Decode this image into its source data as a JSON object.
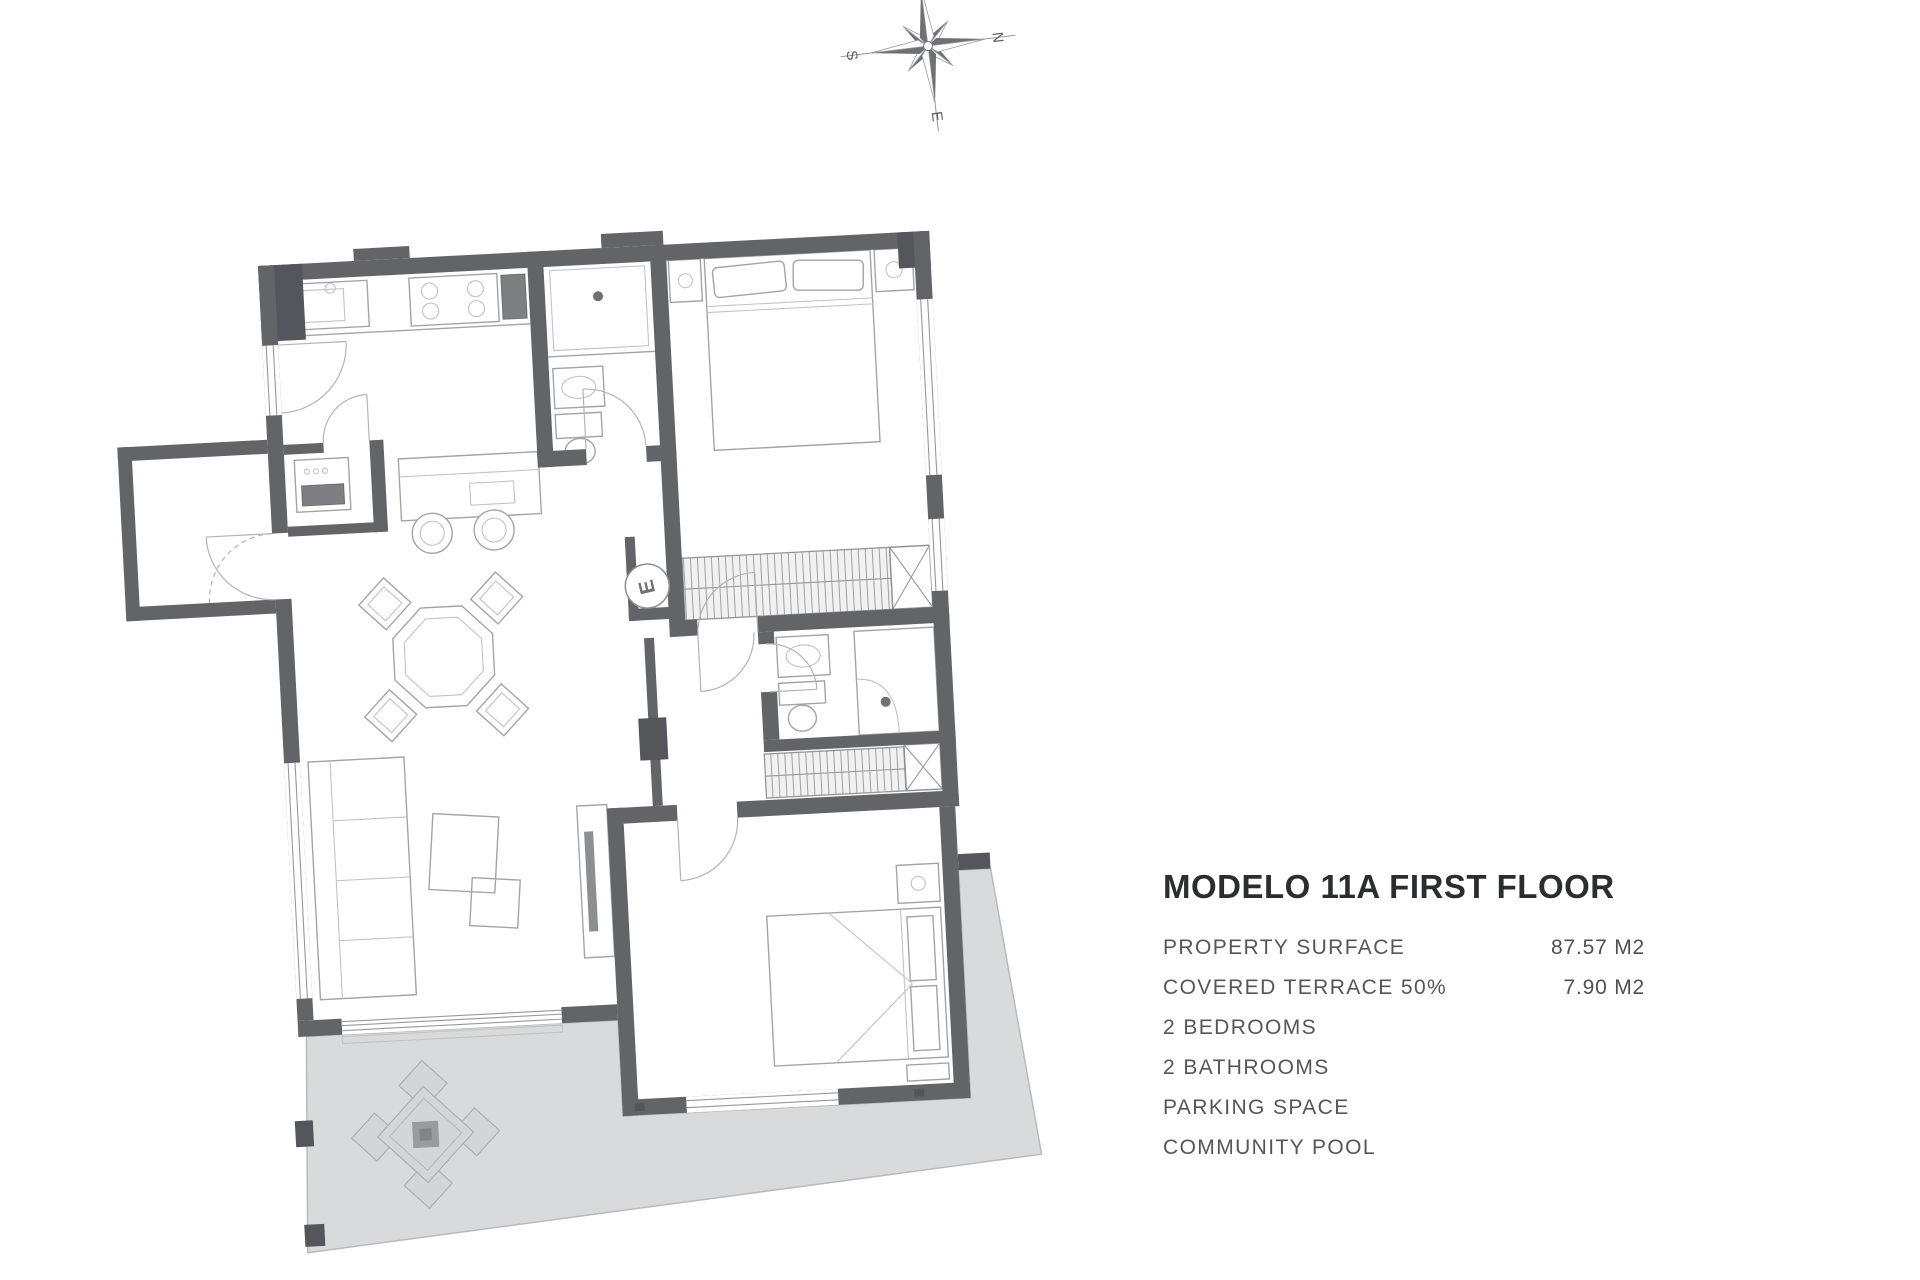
{
  "title": "MODELO 11A FIRST FLOOR",
  "specs": {
    "rows": [
      {
        "label": "PROPERTY SURFACE",
        "value": "87.57 M2"
      },
      {
        "label": "COVERED TERRACE 50%",
        "value": "7.90 M2"
      },
      {
        "label": "2 BEDROOMS",
        "value": ""
      },
      {
        "label": "2 BATHROOMS",
        "value": ""
      },
      {
        "label": "PARKING SPACE",
        "value": ""
      },
      {
        "label": "COMMUNITY POOL",
        "value": ""
      }
    ]
  },
  "compass": {
    "labels": {
      "north": "N",
      "east": "E",
      "south": "S",
      "west": "W"
    }
  },
  "floor_plan": {
    "electrical_panel_label": "E",
    "colors": {
      "wall": "#636468",
      "wall_dark": "#55565b",
      "terrace_fill": "#d9dadb",
      "furniture_line": "#a3a4a7",
      "title_text": "#2c2d2f",
      "spec_text": "#55565a"
    }
  }
}
